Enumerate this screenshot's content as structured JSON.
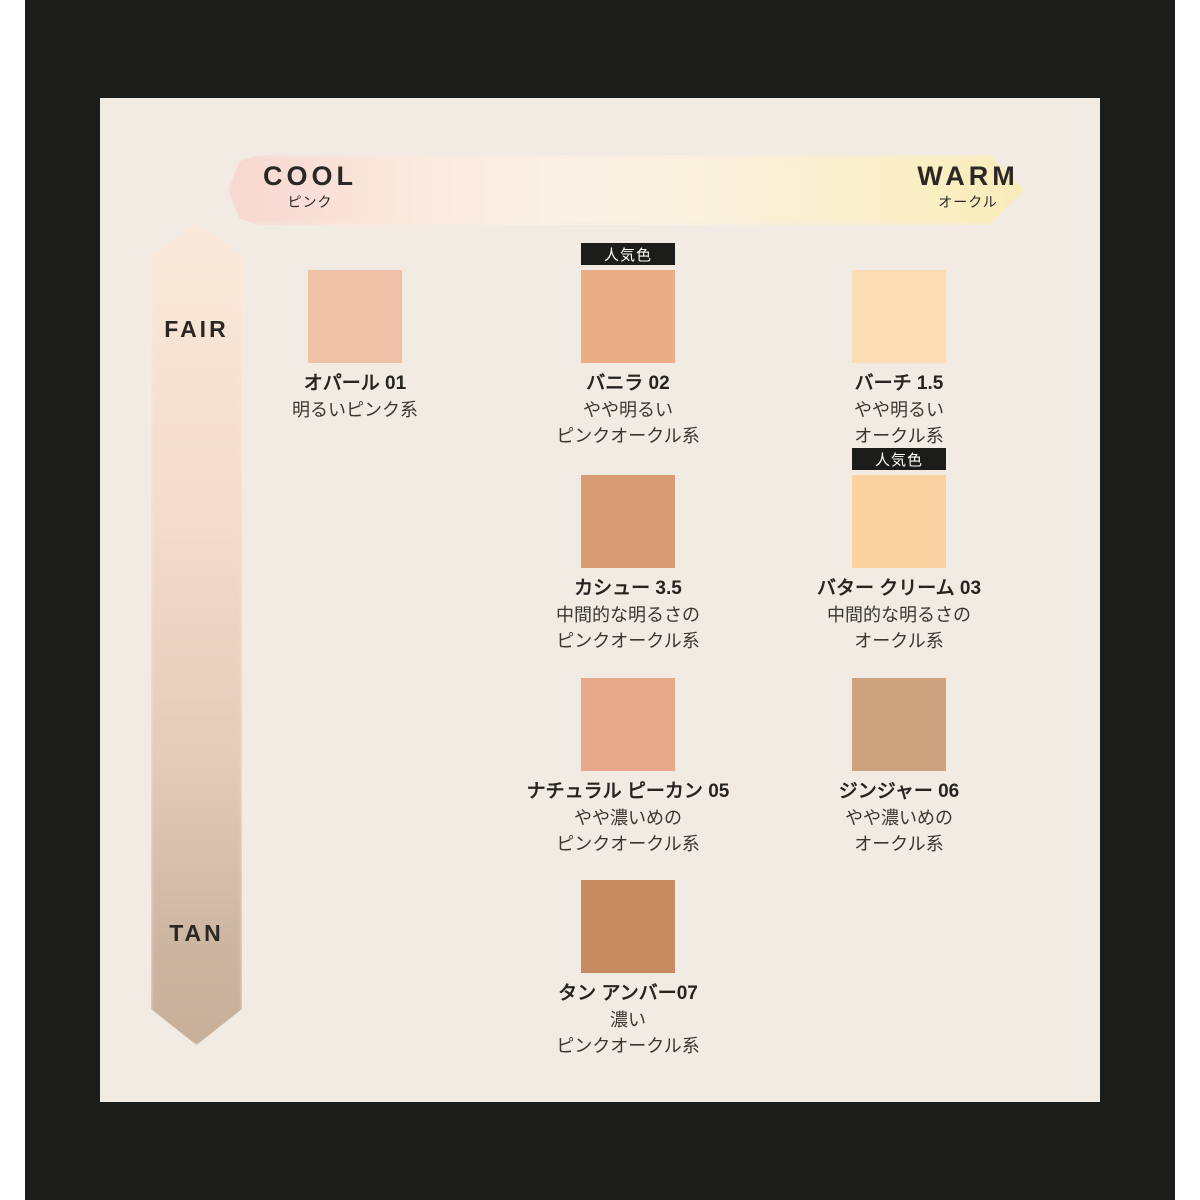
{
  "page": {
    "background_color": "#ffffff",
    "frame_color": "#1c1c1a",
    "panel_color": "#f1ebe4"
  },
  "axes": {
    "horizontal": {
      "left_label": "COOL",
      "left_sublabel": "ピンク",
      "right_label": "WARM",
      "right_sublabel": "オークル",
      "gradient": [
        "#f7d7d1",
        "#fbf2e7",
        "#f8ecba"
      ]
    },
    "vertical": {
      "top_label": "FAIR",
      "bottom_label": "TAN",
      "gradient": [
        "#fae9db",
        "#c7af9a"
      ]
    }
  },
  "popular_badge_label": "人気色",
  "shades": [
    {
      "name": "オパール 01",
      "desc": "明るいピンク系",
      "color": "#efc1a6",
      "popular": false
    },
    {
      "name": "バニラ 02",
      "desc": "やや明るい\nピンクオークル系",
      "color": "#eaad85",
      "popular": true
    },
    {
      "name": "バーチ 1.5",
      "desc": "やや明るい\nオークル系",
      "color": "#fbdcb3",
      "popular": false
    },
    {
      "name": "カシュー 3.5",
      "desc": "中間的な明るさの\nピンクオークル系",
      "color": "#d99b73",
      "popular": false
    },
    {
      "name": "バター クリーム 03",
      "desc": "中間的な明るさの\nオークル系",
      "color": "#fbd3a2",
      "popular": true
    },
    {
      "name": "ナチュラル ピーカン 05",
      "desc": "やや濃いめの\nピンクオークル系",
      "color": "#e6aa8b",
      "popular": false
    },
    {
      "name": "ジンジャー 06",
      "desc": "やや濃いめの\nオークル系",
      "color": "#cda37f",
      "popular": false
    },
    {
      "name": "タン アンバー07",
      "desc": "濃い\nピンクオークル系",
      "color": "#c78a61",
      "popular": false
    }
  ]
}
